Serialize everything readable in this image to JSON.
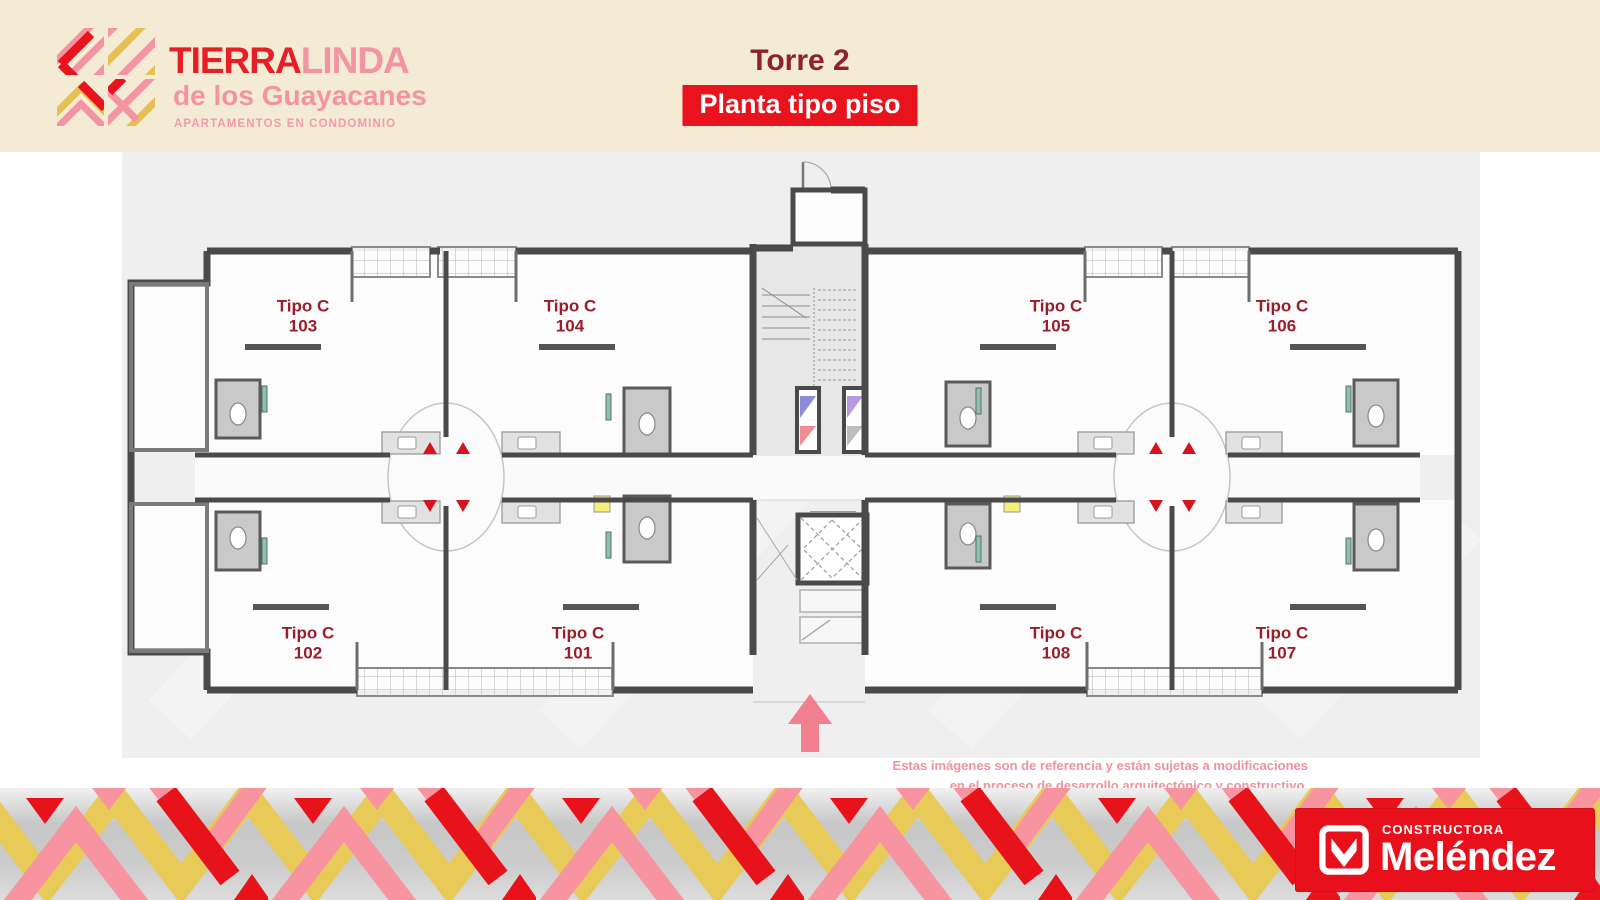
{
  "brand": {
    "name_primary": "TIERRA",
    "name_secondary": "LINDA",
    "subtitle": "de los Guayacanes",
    "tagline": "APARTAMENTOS EN CONDOMINIO"
  },
  "header": {
    "tower_title": "Torre 2",
    "plan_type": "Planta tipo piso"
  },
  "plan": {
    "units": [
      {
        "type": "Tipo C",
        "number": "103"
      },
      {
        "type": "Tipo C",
        "number": "104"
      },
      {
        "type": "Tipo C",
        "number": "105"
      },
      {
        "type": "Tipo C",
        "number": "106"
      },
      {
        "type": "Tipo C",
        "number": "102"
      },
      {
        "type": "Tipo C",
        "number": "101"
      },
      {
        "type": "Tipo C",
        "number": "108"
      },
      {
        "type": "Tipo C",
        "number": "107"
      }
    ]
  },
  "disclaimer": {
    "line1": "Estas imágenes son de referencia y están sujetas a modificaciones",
    "line2": "en el proceso de desarrollo arquitectónico y constructivo."
  },
  "footer": {
    "company_type": "CONSTRUCTORA",
    "company_name": "Meléndez"
  },
  "colors": {
    "header_bg": "#f4ebd4",
    "brand_red": "#e8131d",
    "brand_pink": "#f493a2",
    "brand_yellow": "#e7ca58",
    "title_dark_red": "#8e2130",
    "unit_label_red": "#9a1e2a",
    "wall_gray": "#4a4a4a",
    "plan_bg": "#efeff0",
    "marker_red": "#d61420",
    "arrow_pink": "#f27f8d"
  }
}
